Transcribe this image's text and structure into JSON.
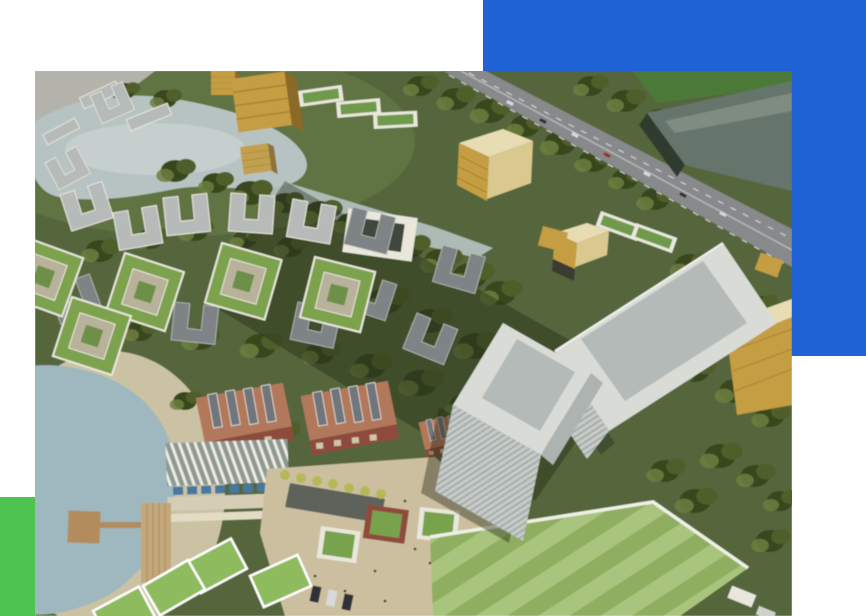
{
  "canvas": {
    "width": 866,
    "height": 616,
    "background": "#ffffff"
  },
  "accent_blocks": {
    "blue": {
      "color": "#1f62d6",
      "x": 483,
      "y": 0,
      "width": 383,
      "height": 356
    },
    "green": {
      "color": "#4ec350",
      "x": 0,
      "y": 497,
      "width": 35,
      "height": 119
    }
  },
  "photo": {
    "x": 35,
    "y": 71,
    "width": 757,
    "height": 545,
    "alt": "Aerial architectural rendering of a mixed-use campus masterplan: a kidney-shaped lake ringed by U-shaped apartment blocks and green-roof courtyard buildings, gold cube offices, a diagonal multi-lane highway with a large grey big-box hall, twin light-grey glass towers, red-brick industrial halls, a waterfront lido with pools and pier, a paved plaza and a striped green event lawn",
    "palette": {
      "ground": "#55663c",
      "ground_light": "#6e7f49",
      "road_patch": "#b3b3ac",
      "tree_dark": "#38471f",
      "tree_mid": "#4f5f2c",
      "tree_light": "#6d7f3f",
      "canopy_shadow": "#1d2412",
      "water_upper": "#b7c3c2",
      "water_sheen": "#cdd6d2",
      "water_lower": "#9fb7be",
      "sand": "#cbc2a4",
      "wall_white": "#e9e7dc",
      "roof_grey": "#b6bab8",
      "roof_grey_dark": "#7e8485",
      "courtyard_ring": "#7ba24e",
      "courtyard_inner": "#b8b29b",
      "courtyard_green": "#6d8f46",
      "gold": "#c59d42",
      "gold_dark": "#8a6a28",
      "cream": "#e8dcb2",
      "cream_face": "#d9c98f",
      "slab_green": "#6f9a4c",
      "road": "#87898b",
      "road_line": "#d9dadb",
      "box_roof": "#66756c",
      "box_sheen": "#8a958c",
      "box_wall": "#2e3a2f",
      "top_lawn": "#4b7a39",
      "tower_light": "#d9dbd6",
      "tower_mid": "#c6cbc8",
      "tower_side": "#adb3b1",
      "tower_roof": "#b3bab8",
      "hall_roof": "#b2785c",
      "hall_skylight": "#71747b",
      "brick": "#8e4b3c",
      "plaza": "#ccbf9f",
      "plaza_tree": "#b4b957",
      "canal": "#49544e",
      "pool": "#47789f",
      "lido_base": "#8d9894",
      "fin_white": "#eceae0",
      "deck": "#d5cdb5",
      "pier": "#b28c5c",
      "timber": "#c4a87b",
      "lawn_light": "#a9c47d",
      "lawn_dark": "#8fae5f",
      "panel_green": "#8fbb5e",
      "rim_white": "#eef0e6",
      "car_white": "#d7d9da",
      "car_dark": "#2f3338",
      "car_red": "#973024",
      "people": "#2e2e2c"
    }
  }
}
